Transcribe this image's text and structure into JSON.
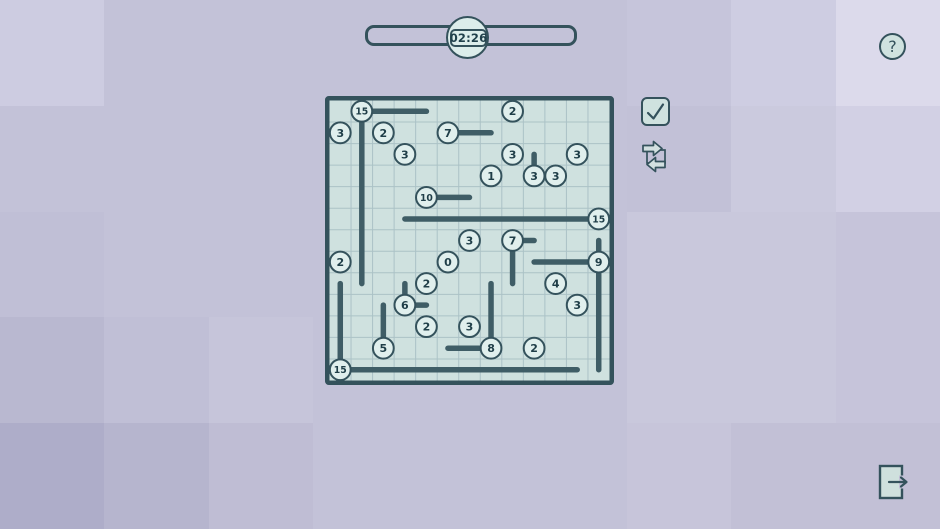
{
  "timer": {
    "value": "02:26"
  },
  "help": {
    "glyph": "?"
  },
  "palette": {
    "background_base": "#c3c2d8",
    "dark_slate": "#34525c",
    "line_stroke": "#3f5d66",
    "board_bg": "#cfe1df",
    "grid_line": "#abc2c6",
    "circle_fill": "#e0efed",
    "digit_color": "#1f3e48",
    "button_fill": "#cfe2df",
    "door_fill": "#cfe0dd",
    "exit_tile": "#c2c0d6",
    "arrow_fill": "#d2e0e0"
  },
  "background_tiles": [
    [
      "#cdcce1",
      "#c3c2d8",
      "#c3c2d8",
      "#c3c2d8",
      "#c3c2d8",
      "#c3c2d8",
      "#c6c5db",
      "#cecde2",
      "#dcdaeb"
    ],
    [
      "#c3c2d8",
      "#c3c2d8",
      "#c3c2d8",
      "#c3c2d8",
      "#c3c2d8",
      "#c3c2d8",
      "#c2c1d7",
      "#cbcade",
      "#d2d0e4"
    ],
    [
      "#c0bfd6",
      "#c3c2d8",
      "#c3c2d8",
      "#c3c2d8",
      "#c3c2d8",
      "#c3c2d8",
      "#c9c8dc",
      "#c9c8dc",
      "#c6c4da"
    ],
    [
      "#b9b8d0",
      "#c0bfd6",
      "#c6c5da",
      "#c3c2d8",
      "#c3c2d8",
      "#c3c2d8",
      "#c9c8dc",
      "#c9c8dc",
      "#c6c4da"
    ],
    [
      "#aeadc9",
      "#b6b5ce",
      "#bfbdd4",
      "#c3c2d8",
      "#c3c2d8",
      "#c3c2d8",
      "#c7c5da",
      "#c2c0d6",
      "#c2c0d6"
    ]
  ],
  "board": {
    "cols": 13,
    "rows": 13,
    "circles": [
      {
        "col": 1,
        "row": 0,
        "value": "15"
      },
      {
        "col": 8,
        "row": 0,
        "value": "2"
      },
      {
        "col": 0,
        "row": 1,
        "value": "3"
      },
      {
        "col": 2,
        "row": 1,
        "value": "2"
      },
      {
        "col": 5,
        "row": 1,
        "value": "7"
      },
      {
        "col": 3,
        "row": 2,
        "value": "3"
      },
      {
        "col": 8,
        "row": 2,
        "value": "3"
      },
      {
        "col": 11,
        "row": 2,
        "value": "3"
      },
      {
        "col": 7,
        "row": 3,
        "value": "1"
      },
      {
        "col": 9,
        "row": 3,
        "value": "3"
      },
      {
        "col": 10,
        "row": 3,
        "value": "3"
      },
      {
        "col": 4,
        "row": 4,
        "value": "10"
      },
      {
        "col": 12,
        "row": 5,
        "value": "15"
      },
      {
        "col": 6,
        "row": 6,
        "value": "3"
      },
      {
        "col": 8,
        "row": 6,
        "value": "7"
      },
      {
        "col": 0,
        "row": 7,
        "value": "2"
      },
      {
        "col": 5,
        "row": 7,
        "value": "0"
      },
      {
        "col": 12,
        "row": 7,
        "value": "9"
      },
      {
        "col": 4,
        "row": 8,
        "value": "2"
      },
      {
        "col": 10,
        "row": 8,
        "value": "4"
      },
      {
        "col": 3,
        "row": 9,
        "value": "6"
      },
      {
        "col": 11,
        "row": 9,
        "value": "3"
      },
      {
        "col": 4,
        "row": 10,
        "value": "2"
      },
      {
        "col": 6,
        "row": 10,
        "value": "3"
      },
      {
        "col": 2,
        "row": 11,
        "value": "5"
      },
      {
        "col": 7,
        "row": 11,
        "value": "8"
      },
      {
        "col": 9,
        "row": 11,
        "value": "2"
      },
      {
        "col": 0,
        "row": 12,
        "value": "15"
      }
    ],
    "segments": [
      [
        1,
        0,
        4,
        0
      ],
      [
        1,
        0,
        1,
        8
      ],
      [
        5,
        1,
        7,
        1
      ],
      [
        9,
        2,
        9,
        3
      ],
      [
        4,
        4,
        6,
        4
      ],
      [
        3,
        5,
        12,
        5
      ],
      [
        8,
        6,
        9,
        6
      ],
      [
        8,
        6,
        8,
        8
      ],
      [
        12,
        6,
        12,
        7
      ],
      [
        9,
        7,
        12,
        7
      ],
      [
        12,
        7,
        12,
        12
      ],
      [
        0,
        8,
        0,
        12
      ],
      [
        3,
        8,
        3,
        9
      ],
      [
        3,
        9,
        4,
        9
      ],
      [
        2,
        9,
        2,
        11
      ],
      [
        7,
        8,
        7,
        11
      ],
      [
        5,
        11,
        7,
        11
      ],
      [
        0,
        12,
        11,
        12
      ]
    ]
  },
  "controls": [
    {
      "id": "check-button",
      "icon": "checkmark-icon"
    },
    {
      "id": "shuffle-button",
      "icon": "swap-arrows-icon"
    },
    {
      "id": "help-button",
      "icon": "question-mark-icon"
    },
    {
      "id": "exit-button",
      "icon": "exit-door-icon"
    }
  ]
}
